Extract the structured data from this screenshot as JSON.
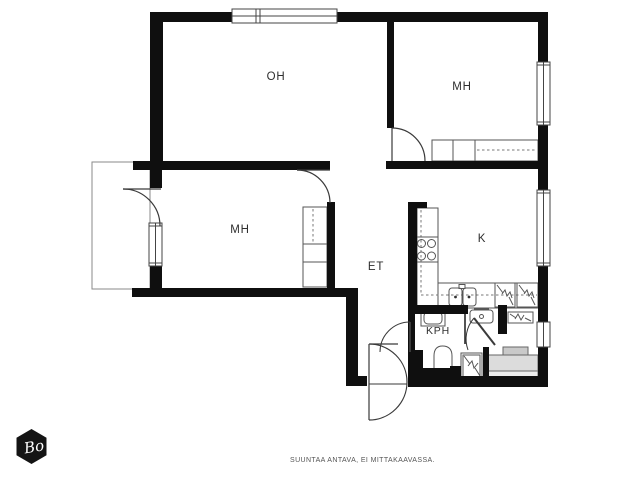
{
  "floor_plan": {
    "rooms": [
      {
        "id": "oh",
        "label": "OH"
      },
      {
        "id": "mh-top",
        "label": "MH"
      },
      {
        "id": "mh-left",
        "label": "MH"
      },
      {
        "id": "et",
        "label": "ET"
      },
      {
        "id": "k",
        "label": "K"
      },
      {
        "id": "kph",
        "label": "KPH"
      }
    ],
    "footer_note": "SUUNTAA ANTAVA, EI MITTAKAAVASSA.",
    "logo_text": "Bo",
    "colors": {
      "wall": "#0f0f0f",
      "thin_line": "#3a3a3a",
      "fixture_line": "#555555",
      "bench_dark": "#c9c9c9",
      "bench_mid": "#dcdcdc",
      "bench_light": "#ececec",
      "background": "#ffffff"
    }
  }
}
